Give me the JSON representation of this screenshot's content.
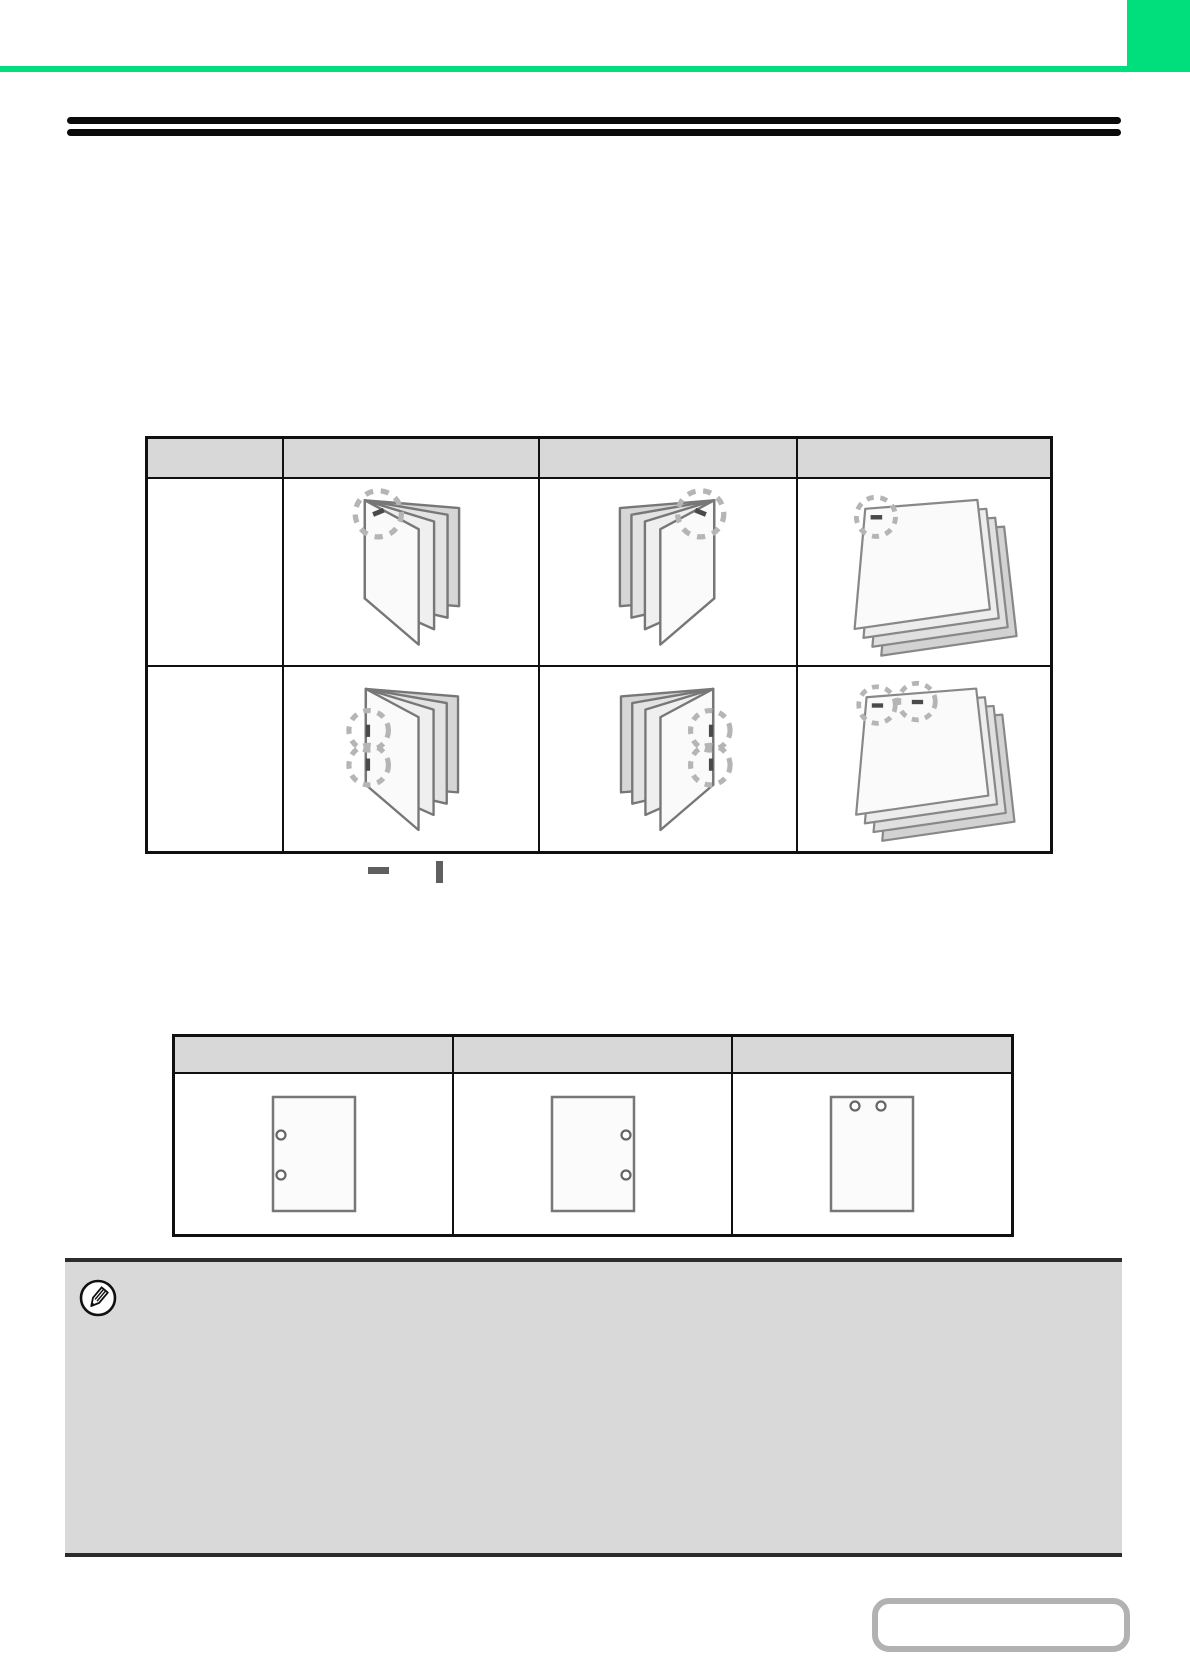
{
  "page": {
    "kind": "printer-manual-page",
    "background_color": "#ffffff",
    "accent_green": "#00df7c",
    "note_background": "#d9d9d9",
    "table_header_background": "#d8d8d8",
    "rule_color": "#0a0a0a",
    "dashed_circle_color": "#b5b5b5",
    "staple_mark_color": "#4a4a4a",
    "visible_text": ""
  },
  "header": {
    "green_corner_block": "solid green rectangle top-right",
    "green_bar": "full-width green horizontal bar",
    "title_text": ""
  },
  "title_rule": {
    "style": "double black horizontal rule",
    "lines": 2
  },
  "staple_table": {
    "columns": 4,
    "header_labels": [
      "",
      "",
      "",
      ""
    ],
    "rows": [
      {
        "label": "",
        "cells": [
          "booklet-left-bound-one-staple-top",
          "booklet-right-bound-one-staple-top",
          "sheet-stack-one-staple-top-left"
        ]
      },
      {
        "label": "",
        "cells": [
          "booklet-left-bound-two-staples-side",
          "booklet-right-bound-two-staples-side",
          "sheet-stack-two-staples-top"
        ]
      }
    ]
  },
  "legend": {
    "symbols": [
      "horizontal-staple-mark",
      "vertical-staple-mark"
    ],
    "text": ""
  },
  "punch_table": {
    "columns": 3,
    "header_labels": [
      "",
      "",
      ""
    ],
    "cells": [
      "sheet-punched-left-edge",
      "sheet-punched-right-edge",
      "sheet-punched-top-edge"
    ]
  },
  "note": {
    "icon": "pencil-icon",
    "text": ""
  },
  "footer": {
    "page_link_box_label": ""
  }
}
